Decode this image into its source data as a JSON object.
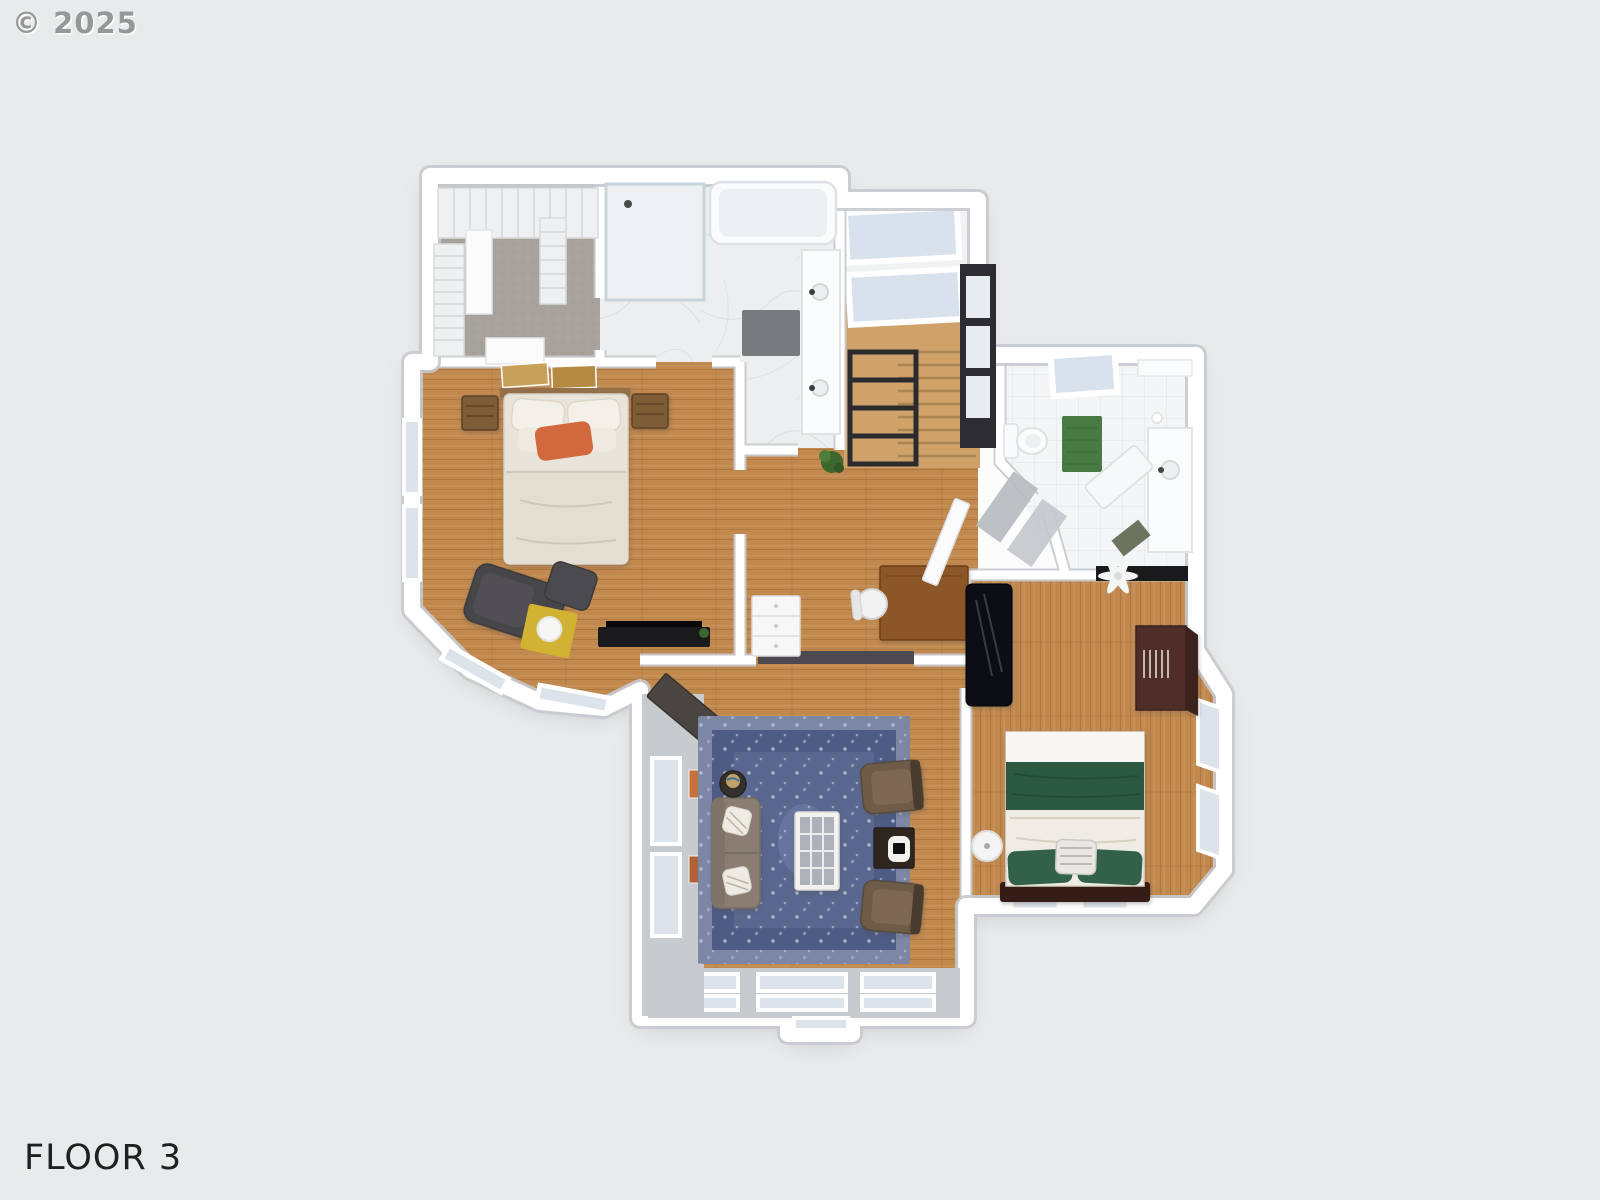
{
  "watermark": "© 2025",
  "floor_label": "FLOOR 3",
  "colors": {
    "background": "#e9eaeb",
    "watermark_color": "#96979a",
    "label_color": "#1f2023",
    "wall": "#fcfcfd",
    "wall_edge": "#c7cace",
    "wood": "#c2894f",
    "wood_dark": "#9f6b33",
    "wood_stairs": "#cfa269",
    "carpet": "#a7a29b",
    "marble": "#eceef0",
    "marble_vein": "#d9dce0",
    "tile": "#f3f5f7",
    "tile_line": "#e1e5e9",
    "glass": "#dde3ea",
    "skylight": "#d9e1ec",
    "dark_window": "#2d2c32",
    "header": "#4c4a4e",
    "rug_border": "#7c87a6",
    "rug_mid": "#4e5b84",
    "rug_field": "#5a6890",
    "rug_dot": "#c3cad9",
    "sofa": "#8a7e72",
    "armchair": "#6e5c49",
    "table_dark": "#2f2620",
    "bed1_duvet": "#e9e4da",
    "pillow_orange": "#d2683e",
    "nightstand": "#7d5b37",
    "headboard1": "#93704a",
    "chaise": "#474649",
    "table_yellow": "#d2b232",
    "media_black": "#1a1a1c",
    "bed2_white": "#f0ede7",
    "bed2_green": "#2b5940",
    "pillow_green": "#30604a",
    "headboard2": "#361c12",
    "piano": "#0f0f13",
    "wardrobe": "#4f2e2c",
    "wardrobe_dark": "#3a201f",
    "desk": "#8d5627",
    "mat_gray": "#797a7e",
    "mat_green": "#4a7a44",
    "plant": "#3c672f",
    "railing": "#2a2a2f",
    "art_tan": "#c7a159",
    "art_gold": "#b68a41"
  }
}
